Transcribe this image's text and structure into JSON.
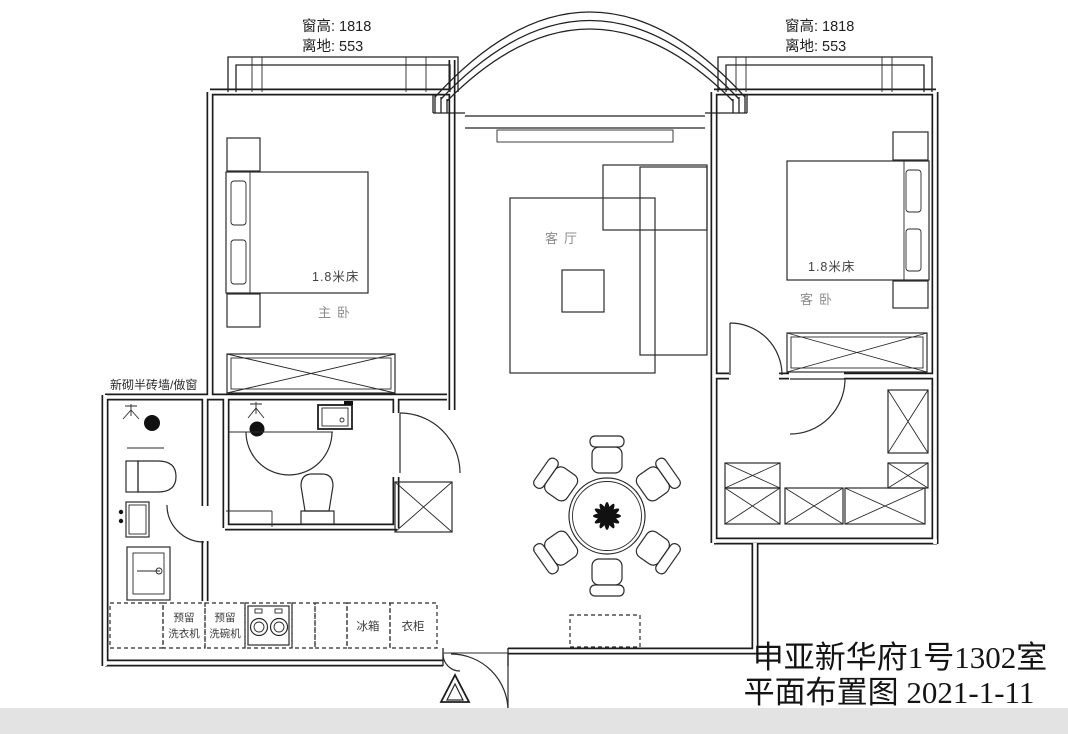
{
  "colors": {
    "line": "#1c1c1c",
    "muted": "#8c8c8c",
    "ink": "#141414",
    "strip": "#e3e3e3",
    "paper": "#ffffff"
  },
  "window_note_left": {
    "line1": "窗高: 1818",
    "line2": "离地: 553"
  },
  "window_note_right": {
    "line1": "窗高: 1818",
    "line2": "离地: 553"
  },
  "rooms": {
    "living": "客厅",
    "master": "主卧",
    "guest": "客卧"
  },
  "beds": {
    "master": "1.8米床",
    "guest": "1.8米床"
  },
  "wall_note": "新砌半砖墙/做窗",
  "kitchen": {
    "washer_l1": "预留",
    "washer_l2": "洗衣机",
    "dishwasher_l1": "预留",
    "dishwasher_l2": "洗碗机",
    "fridge": "冰箱",
    "wardrobe": "衣柜"
  },
  "title": {
    "line1": "申亚新华府1号1302室",
    "line2": "平面布置图  2021-1-11"
  }
}
